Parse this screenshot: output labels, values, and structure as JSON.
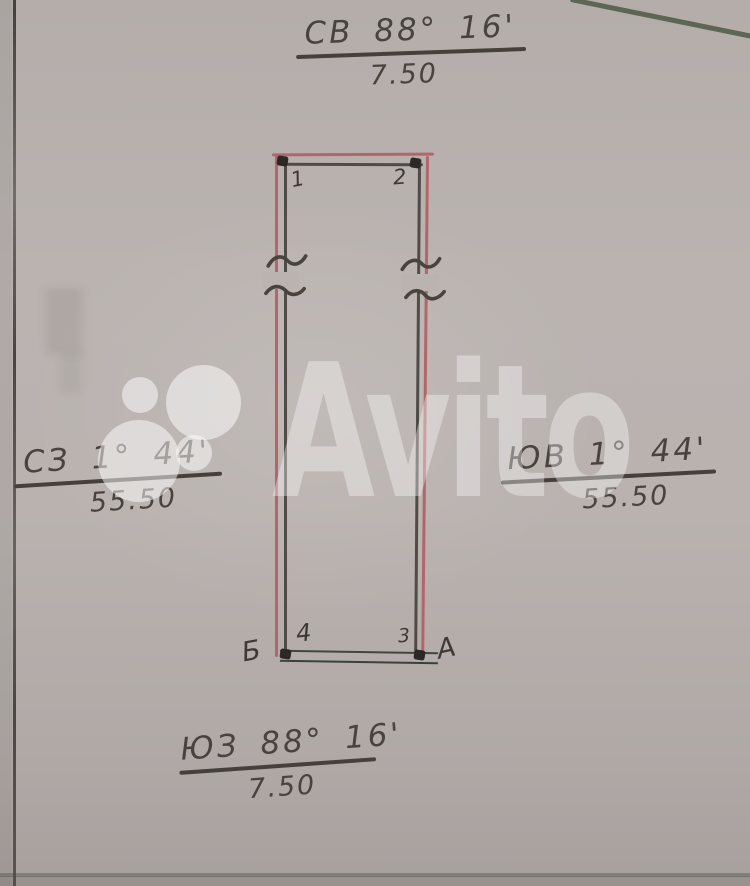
{
  "plan": {
    "bearings": {
      "top": {
        "label": "СВ 88° 16'",
        "distance": "7.50"
      },
      "left": {
        "label": "СЗ 1° 44'",
        "distance": "55.50"
      },
      "right": {
        "label": "ЮВ 1° 44'",
        "distance": "55.50"
      },
      "bottom": {
        "label": "ЮЗ 88° 16'",
        "distance": "7.50"
      }
    },
    "vertices": {
      "top_left": "1",
      "top_right": "2",
      "bottom_right": "3",
      "bottom_left": "4"
    },
    "points": {
      "bottom_left": "Б",
      "bottom_right": "А"
    }
  },
  "watermark": {
    "brand": "Avito"
  },
  "colors": {
    "paper": "#b7b0ad",
    "ink": "#49433e",
    "boundary_red": "#b2666c",
    "boundary_ink": "#4f4946",
    "baseline_dark": "#3f473f"
  }
}
